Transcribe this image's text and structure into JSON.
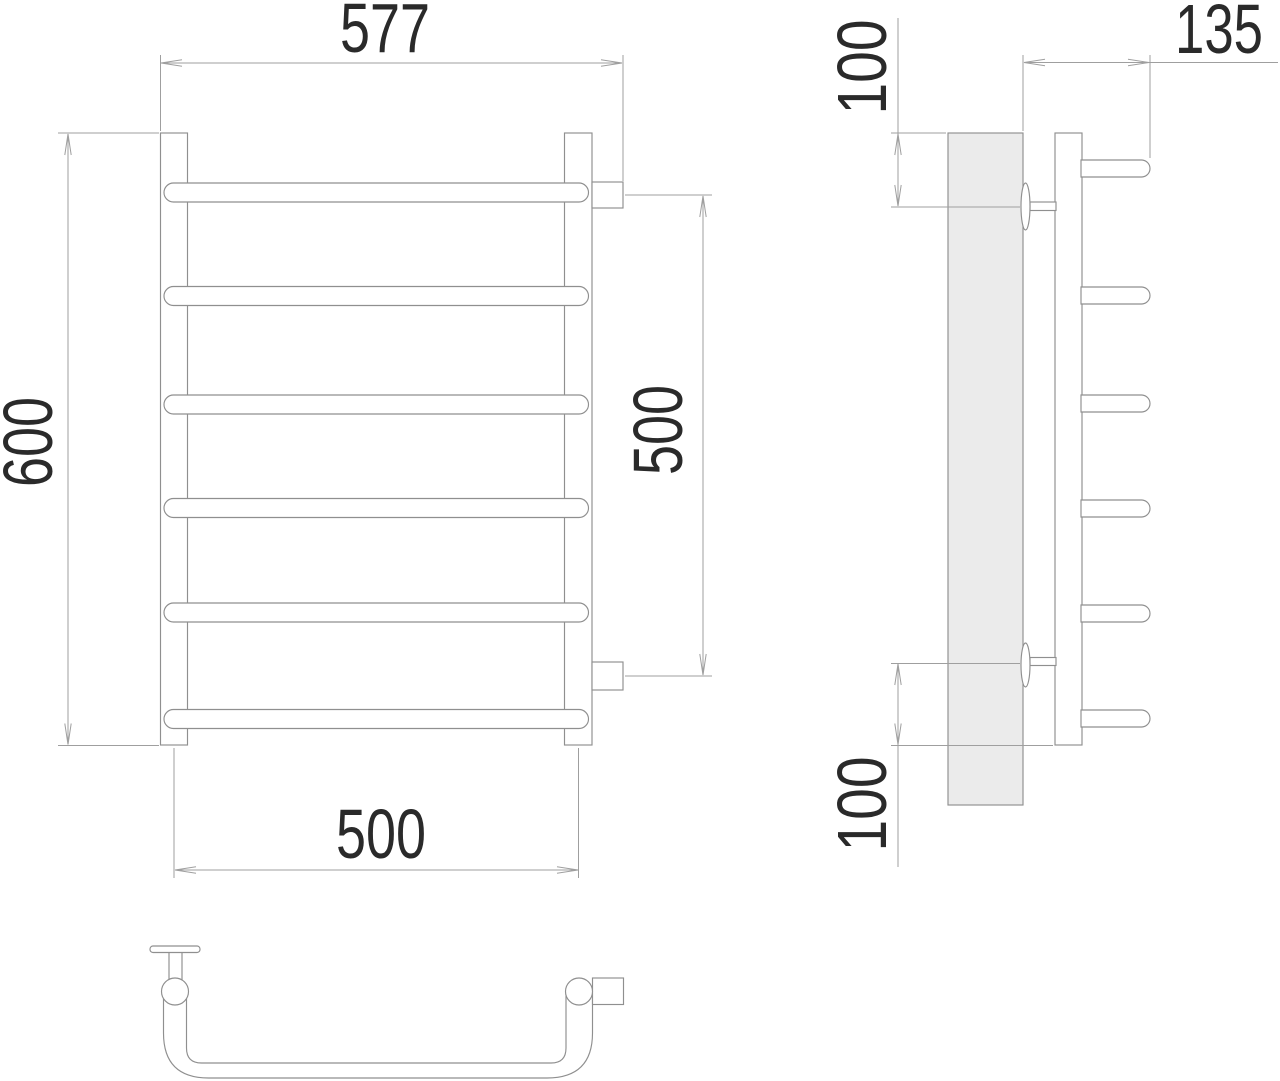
{
  "drawing": {
    "dimensions": {
      "front_overall_width": "577",
      "front_overall_height": "600",
      "front_connector_spacing": "500",
      "front_rail_center_spacing": "500",
      "side_depth": "135",
      "side_top_offset": "100",
      "side_bottom_offset": "100"
    },
    "colors": {
      "line": "#8f8f8f",
      "dim_line": "#9f9f9f",
      "text": "#2a2a2a",
      "plate_fill": "#ebebeb",
      "background": "#ffffff"
    }
  }
}
